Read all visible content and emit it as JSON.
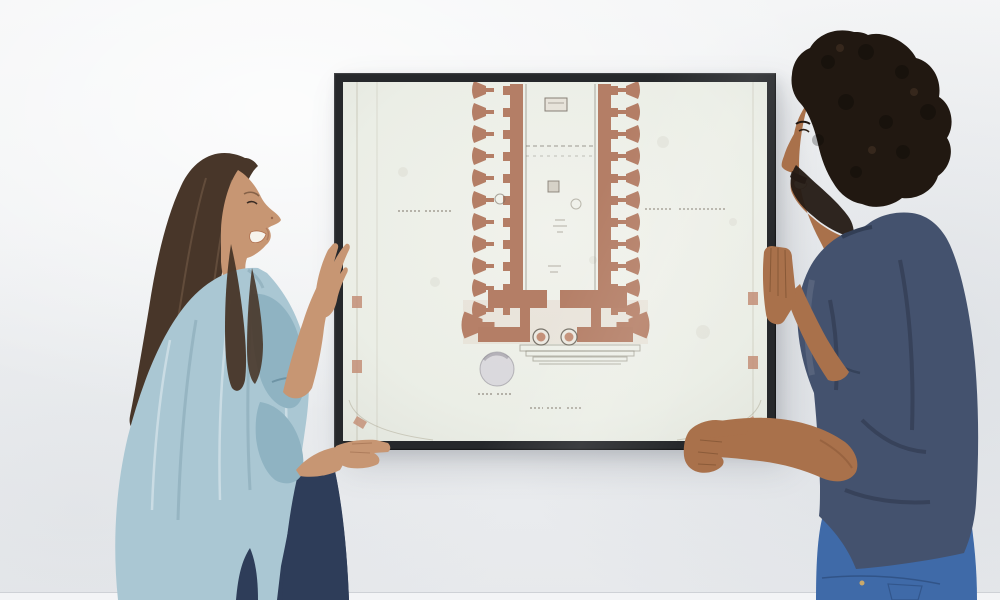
{
  "scene": {
    "description": "A smiling woman in a light-blue shirt and a smiling man in a navy t-shirt hold a black-framed antique architectural floor plan against a bright white wall while hanging it.",
    "setting": "bright interior wall, soft daylight",
    "caption": "Couple hanging a framed temple floor-plan drawing"
  },
  "people": {
    "woman": {
      "position": "left",
      "facing": "right",
      "expression": "smiling, eyes closed",
      "hair": "long dark brown",
      "top": "light blue button-up shirt, sleeves to wrist",
      "bottom": "dark navy jeans",
      "action": "left hand on frame left edge, right hand under bottom-left corner"
    },
    "man": {
      "position": "right",
      "facing": "left",
      "expression": "smiling",
      "hair": "dark curly afro with beard",
      "top": "navy blue t-shirt",
      "bottom": "medium blue jeans",
      "action": "right hand on frame right edge, left hand gripping bottom-right corner"
    }
  },
  "artwork": {
    "type": "antique architectural floor plan of a classical temple",
    "frame_style": "thin black gallery frame",
    "paper_tone": "aged off-white",
    "ink": "terracotta walls and columns, faint gray annotations",
    "labels_legible": false,
    "features": [
      "double colonnade walls",
      "cella with altar marks",
      "entrance columns",
      "steps",
      "circular well",
      "faded captions"
    ]
  },
  "colors": {
    "wall_base": "#eef0f2",
    "floor": "#f3f4f6",
    "frame": "#26282b",
    "paper": "#edefe9",
    "terracotta": "#b47e66",
    "terracotta_light": "#c49078",
    "plan_line": "#7d7666",
    "well_fill": "#d8d6dc",
    "woman_skin": "#c79673",
    "woman_hair": "#483629",
    "woman_shirt": "#aac7d3",
    "woman_shirt_shade": "#8fb3c2",
    "woman_jeans": "#2e3d59",
    "man_skin": "#a9714b",
    "man_hair": "#211811",
    "man_shirt": "#44526e",
    "man_shirt_shade": "#323e55",
    "man_jeans": "#3f6aa8",
    "teeth": "#f7f3ec"
  }
}
